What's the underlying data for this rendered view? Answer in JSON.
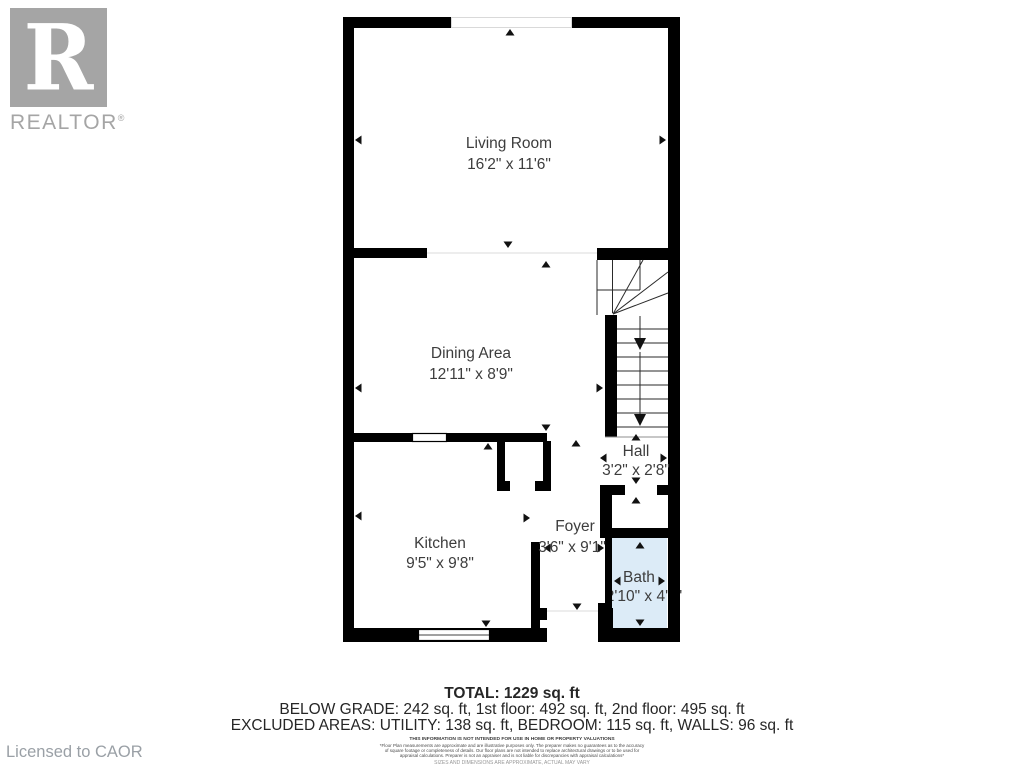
{
  "branding": {
    "logo_letter": "R",
    "logo_wordmark": "REALTOR",
    "registered_mark": "®",
    "licensed_to": "Licensed to CAOR"
  },
  "rooms": [
    {
      "name": "Living Room",
      "dims": "16'2\" x 11'6\""
    },
    {
      "name": "Dining Area",
      "dims": "12'11\" x 8'9\""
    },
    {
      "name": "Kitchen",
      "dims": "9'5\" x 9'8\""
    },
    {
      "name": "Foyer",
      "dims": "3'6\" x 9'1\""
    },
    {
      "name": "Hall",
      "dims": "3'2\" x 2'8\""
    },
    {
      "name": "Bath",
      "dims": "2'10\" x 4'1\""
    }
  ],
  "summary": {
    "total": "TOTAL: 1229 sq. ft",
    "floors": "BELOW GRADE: 242 sq. ft, 1st floor: 492 sq. ft, 2nd floor: 495 sq. ft",
    "excluded": "EXCLUDED AREAS: UTILITY: 138 sq. ft, BEDROOM: 115 sq. ft, WALLS: 96 sq. ft"
  },
  "disclaimer": {
    "line1": "THIS INFORMATION IS NOT INTENDED FOR USE IN HOME OR PROPERTY VALUATIONS",
    "line2": "*Floor Plan measurements are approximate and are illustrative purposes only. The preparer makes no guarantees as to the accuracy",
    "line3": "of square footage or completeness of details. Our floor plans are not intended to replace architectural drawings or to be used for",
    "line4": "appraisal calculations. Preparer is not an appraiser and is not liable for discrepancies with appraisal calculations*",
    "line5": "SIZES AND DIMENSIONS ARE APPROXIMATE, ACTUAL MAY VARY"
  },
  "colors": {
    "wall": "#000000",
    "bath_fill": "#dcebf7",
    "room_text": "#3d3d3d",
    "muted_text": "#9aa0a6",
    "logo_gray": "#a5a5a5"
  }
}
